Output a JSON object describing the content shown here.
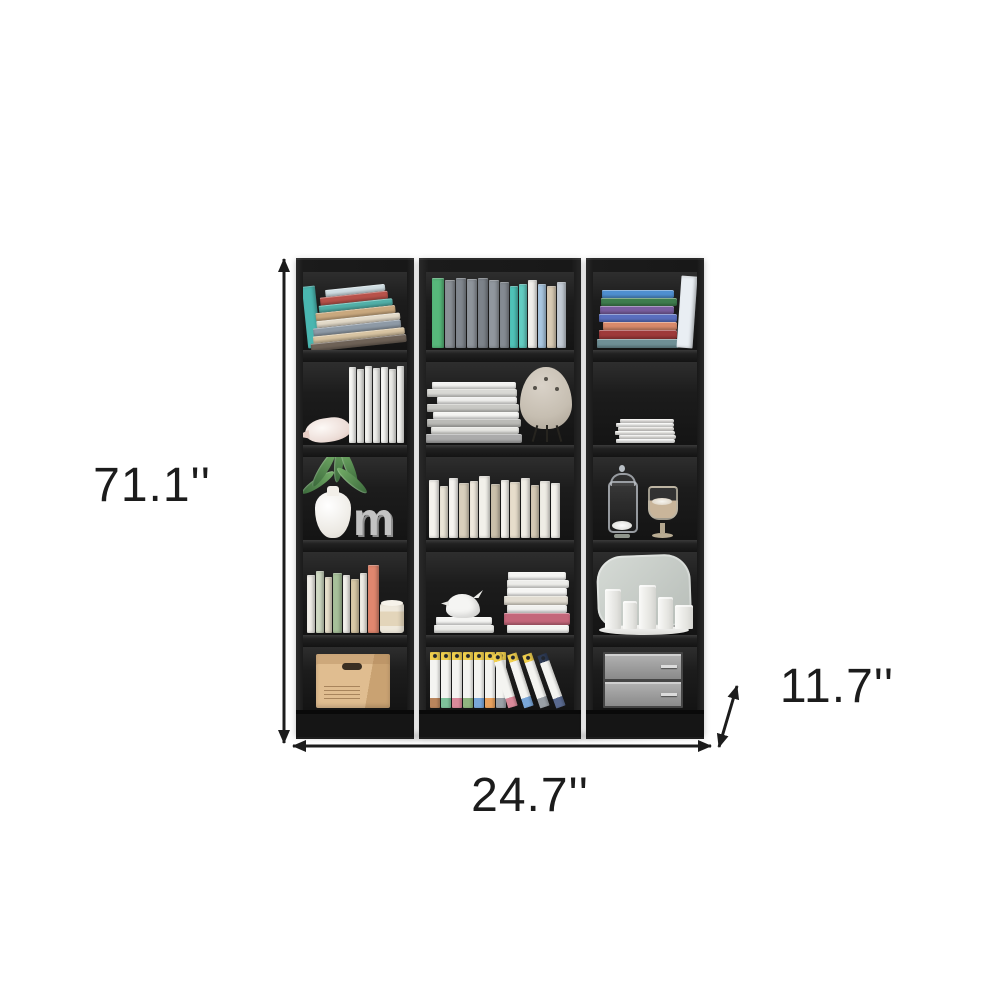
{
  "page": {
    "background_color": "#ffffff",
    "annotation_color": "#1c1c1c"
  },
  "dimension_labels": {
    "height": "71.1''",
    "width": "24.7''",
    "depth": "11.7''"
  },
  "bookcase": {
    "finish": "black",
    "letter_decor": "m",
    "units": [
      {
        "name": "left bookcase",
        "shelf_items": [
          [
            "teal book",
            "leaning stack of colorful books"
          ],
          [
            "conch shell",
            "row of white paperbacks"
          ],
          [
            "green plant in white vase",
            "decorative letter m"
          ],
          [
            "row of pastel books",
            "candle jar"
          ],
          [
            "cardboard storage box"
          ]
        ]
      },
      {
        "name": "middle bookcase",
        "shelf_items": [
          [
            "row of books: green, gray set, teal, white, blue, tan"
          ],
          [
            "stack of magazines",
            "beige egg table lamp on tripod legs"
          ],
          [
            "row of white and cream books"
          ],
          [
            "white bird figurine on flat books",
            "book stack with pink spine"
          ],
          [
            "upright white binders with yellow labels",
            "four leaning binders"
          ]
        ]
      },
      {
        "name": "right bookcase",
        "shelf_items": [
          [
            "stack of colorful books",
            "white standing book"
          ],
          [
            "stack of white papers"
          ],
          [
            "glass apothecary jar with pebbles",
            "glass pedestal jar with sand"
          ],
          [
            "rounded mirror",
            "white pillar candles on marble tray"
          ],
          [
            "gray metal drawer boxes"
          ]
        ]
      }
    ],
    "decor": {
      "u1c1_side": [
        [
          13,
          62,
          "#4ab6b0",
          -6
        ]
      ],
      "u1c1_pile": [
        [
          60,
          7,
          "#cfdde2",
          2
        ],
        [
          68,
          8,
          "#b8524a",
          0
        ],
        [
          74,
          7,
          "#52b0a8",
          1
        ],
        [
          80,
          8,
          "#c9a87e",
          0
        ],
        [
          84,
          7,
          "#e3dac9",
          2
        ],
        [
          88,
          8,
          "#8e9aa6",
          0
        ],
        [
          92,
          7,
          "#d8c4a2",
          1
        ],
        [
          96,
          8,
          "#6e6257",
          0
        ]
      ],
      "u1c2_row": [
        [
          7,
          76,
          "#f6f6f3"
        ],
        [
          7,
          74,
          "#ebebe7"
        ],
        [
          7,
          77,
          "#f4f4f1"
        ],
        [
          7,
          75,
          "#efefec"
        ],
        [
          7,
          76,
          "#f7f7f4"
        ],
        [
          7,
          74,
          "#eaeae6"
        ],
        [
          7,
          77,
          "#f3f3f0"
        ]
      ],
      "u1c4_row": [
        [
          8,
          58,
          "#f1efe9"
        ],
        [
          8,
          62,
          "#cfd9c2"
        ],
        [
          7,
          56,
          "#e8e0cc"
        ],
        [
          9,
          60,
          "#a7c09a"
        ],
        [
          7,
          58,
          "#f3f1ec"
        ],
        [
          8,
          54,
          "#d8c8a6"
        ],
        [
          7,
          60,
          "#efece4"
        ],
        [
          11,
          68,
          "#e0876f"
        ]
      ],
      "u2c1_row": [
        [
          12,
          70,
          "#57b87b"
        ],
        [
          10,
          68,
          "#8a9096"
        ],
        [
          10,
          70,
          "#81878e"
        ],
        [
          10,
          69,
          "#8e949b"
        ],
        [
          10,
          70,
          "#7d838a"
        ],
        [
          10,
          68,
          "#91979e"
        ],
        [
          9,
          66,
          "#858b92"
        ],
        [
          8,
          62,
          "#4fc3b8"
        ],
        [
          8,
          64,
          "#63cdc2"
        ],
        [
          9,
          68,
          "#f0efeb"
        ],
        [
          8,
          64,
          "#a9c7e0"
        ],
        [
          9,
          62,
          "#d9cbb4"
        ],
        [
          9,
          66,
          "#c3cbd4"
        ]
      ],
      "u2c2_pile": [
        [
          84,
          7,
          "#f2f2f0",
          0
        ],
        [
          90,
          8,
          "#d9d9d5",
          -2
        ],
        [
          80,
          7,
          "#efefed",
          3
        ],
        [
          92,
          8,
          "#c9c9c5",
          -1
        ],
        [
          86,
          7,
          "#f4f4f2",
          2
        ],
        [
          94,
          8,
          "#bbbbb7",
          0
        ],
        [
          88,
          7,
          "#e6e6e2",
          1
        ],
        [
          96,
          9,
          "#ababab",
          0
        ]
      ],
      "u2c3_row": [
        [
          10,
          58,
          "#f4f2ed"
        ],
        [
          8,
          52,
          "#eae4d6"
        ],
        [
          9,
          60,
          "#f6f4f0"
        ],
        [
          10,
          55,
          "#d9cfbc"
        ],
        [
          8,
          57,
          "#efe9dd"
        ],
        [
          11,
          62,
          "#f2f0ea"
        ],
        [
          9,
          54,
          "#cbc0ab"
        ],
        [
          8,
          58,
          "#f5f3ee"
        ],
        [
          10,
          56,
          "#e6ddcb"
        ],
        [
          9,
          60,
          "#f1eee7"
        ],
        [
          8,
          53,
          "#d4c9b4"
        ],
        [
          10,
          57,
          "#efece5"
        ],
        [
          9,
          55,
          "#f4f2ed"
        ]
      ],
      "u2c4_base": [
        [
          56,
          8,
          "#f4f4f2",
          0
        ],
        [
          60,
          8,
          "#ebebe8",
          0
        ]
      ],
      "u2c4_stack": [
        [
          58,
          8,
          "#f4f4f2",
          0
        ],
        [
          62,
          8,
          "#ededea",
          1
        ],
        [
          60,
          8,
          "#f6f6f4",
          0
        ],
        [
          64,
          9,
          "#e2ddd2",
          -1
        ],
        [
          60,
          8,
          "#f1f1ef",
          0
        ],
        [
          66,
          12,
          "#c4677a",
          0
        ],
        [
          62,
          8,
          "#f4f4f2",
          1
        ]
      ],
      "u2c5_upright": [
        [
          "#b9855c"
        ],
        [
          "#7fc29b"
        ],
        [
          "#d98a9a"
        ],
        [
          "#8fb57f"
        ],
        [
          "#7aa7d9"
        ],
        [
          "#e8a25f"
        ],
        [
          "#9aa0a6"
        ]
      ],
      "u2c5_leaning": [
        [
          "#d98a9a",
          null,
          -17
        ],
        [
          "#7aa7d9",
          null,
          -18
        ],
        [
          "#9aa0a6",
          null,
          -19
        ],
        [
          "#5a6a8f",
          "#2e3b55",
          -20
        ]
      ],
      "u3c1_pile": [
        [
          72,
          8,
          "#4f8fd0",
          0
        ],
        [
          76,
          8,
          "#3f7d4e",
          1
        ],
        [
          74,
          8,
          "#7a5fa0",
          -1
        ],
        [
          78,
          8,
          "#5a6fbf",
          0
        ],
        [
          74,
          8,
          "#d98a6a",
          2
        ],
        [
          78,
          9,
          "#9e3a3a",
          0
        ],
        [
          82,
          9,
          "#6e8f95",
          0
        ]
      ],
      "u3c1_side": [
        [
          16,
          72,
          "#e9eef3",
          4
        ]
      ],
      "u3c2_pile": [
        [
          54,
          4,
          "#f2f1ee",
          2
        ],
        [
          58,
          4,
          "#fafaf8",
          0
        ],
        [
          56,
          4,
          "#eceae6",
          1
        ],
        [
          60,
          4,
          "#f7f6f3",
          0
        ],
        [
          57,
          4,
          "#f0efec",
          2
        ],
        [
          59,
          4,
          "#fbfbf9",
          0
        ]
      ]
    }
  }
}
